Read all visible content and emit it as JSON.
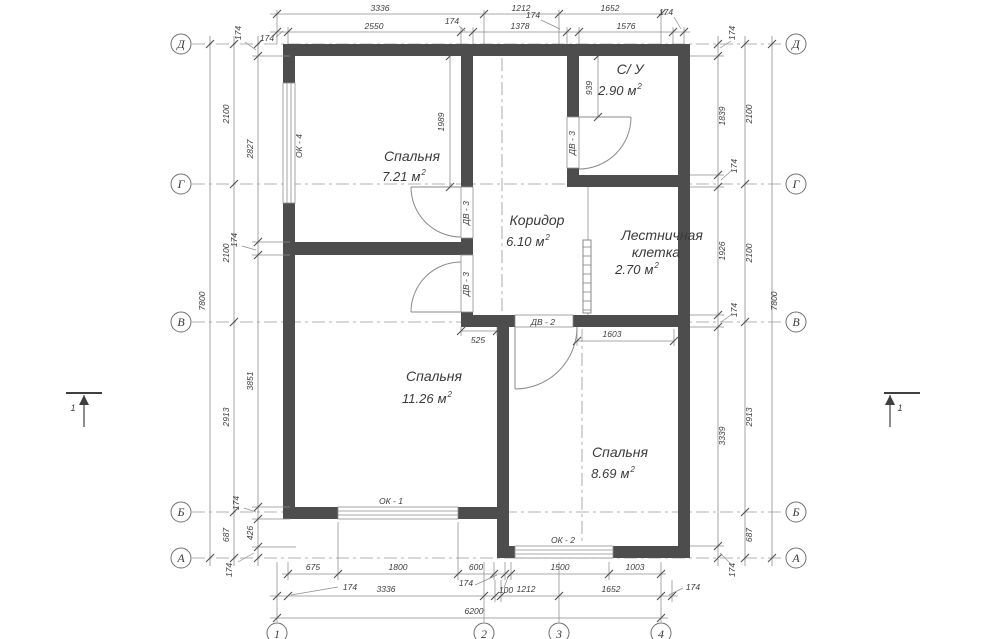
{
  "axes": {
    "letters": [
      "Д",
      "Г",
      "В",
      "Б",
      "А"
    ],
    "numbers": [
      "1",
      "2",
      "3",
      "4"
    ]
  },
  "rooms": [
    {
      "name": "Спальня",
      "area": "7.21",
      "unit": "м",
      "sup": "2"
    },
    {
      "name": "С/ У",
      "area": "2.90",
      "unit": "м",
      "sup": "2"
    },
    {
      "name": "Коридор",
      "area": "6.10",
      "unit": "м",
      "sup": "2"
    },
    {
      "name": "Лестничная",
      "name2": "клетка",
      "area": "2.70",
      "unit": "м",
      "sup": "2"
    },
    {
      "name": "Спальня",
      "area": "11.26",
      "unit": "м",
      "sup": "2"
    },
    {
      "name": "Спальня",
      "area": "8.69",
      "unit": "м",
      "sup": "2"
    }
  ],
  "openings": {
    "windows": [
      {
        "label": "ОК - 4"
      },
      {
        "label": "ОК - 1"
      },
      {
        "label": "ОК - 2"
      }
    ],
    "doors": [
      {
        "label": "ДВ - 3"
      },
      {
        "label": "ДВ - 3"
      },
      {
        "label": "ДВ - 3"
      },
      {
        "label": "ДВ - 2"
      }
    ]
  },
  "section_mark": {
    "label": "1"
  },
  "dimensions": {
    "top_main": [
      "3336",
      "1212",
      "1652"
    ],
    "top_sub": [
      "2550",
      "1378",
      "1576"
    ],
    "top_small": [
      "174",
      "174",
      "174",
      "174"
    ],
    "bottom_sub": [
      "675",
      "1800",
      "600",
      "1500",
      "1003"
    ],
    "bottom_small": [
      "174",
      "174",
      "100",
      "174"
    ],
    "bottom_main": [
      "3336",
      "1212",
      "1652"
    ],
    "bottom_total": "6200",
    "left_outer": "7800",
    "left_mid": [
      "2100",
      "2100",
      "2913",
      "687"
    ],
    "left_inner": [
      "2827",
      "3851",
      "426"
    ],
    "left_small": [
      "174",
      "174",
      "174",
      "174"
    ],
    "right_outer": "7800",
    "right_mid": [
      "2100",
      "2100",
      "2913",
      "687"
    ],
    "right_inner": [
      "1839",
      "1926",
      "3339"
    ],
    "right_small": [
      "174",
      "174",
      "174",
      "174"
    ],
    "interior": {
      "bedroom_top_pier": "1989",
      "wc_pier": "939",
      "corridor_step": "525",
      "bedroom3_width": "1603"
    }
  }
}
